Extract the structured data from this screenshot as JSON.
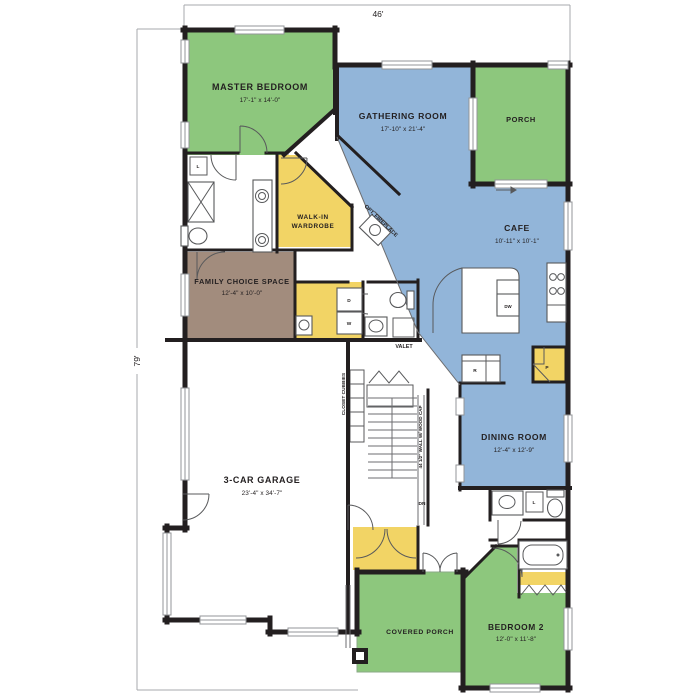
{
  "dims": {
    "width_label": "46'",
    "height_label": "79'"
  },
  "rooms": {
    "master_bedroom": {
      "name": "MASTER BEDROOM",
      "size": "17'-1\" x 14'-0\""
    },
    "gathering_room": {
      "name": "GATHERING ROOM",
      "size": "17'-10\" x 21'-4\""
    },
    "porch": {
      "name": "PORCH"
    },
    "cafe": {
      "name": "CAFE",
      "size": "10'-11\" x 10'-1\""
    },
    "walk_in_wardrobe": {
      "line1": "WALK-IN",
      "line2": "WARDROBE"
    },
    "family_choice": {
      "name": "FAMILY CHOICE SPACE",
      "size": "12'-4\" x 10'-0\""
    },
    "dining_room": {
      "name": "DINING ROOM",
      "size": "12'-4\" x 12'-9\""
    },
    "garage": {
      "name": "3-CAR GARAGE",
      "size": "23'-4\" x 34'-7\""
    },
    "covered_porch": {
      "name": "COVERED PORCH"
    },
    "bedroom_2": {
      "name": "BEDROOM 2",
      "size": "12'-0\" x 11'-8\""
    }
  },
  "annotations": {
    "opt_fireplace": "OPT. FIREPLACE",
    "valet": "VALET",
    "closet_cubbies": "CLOSET CUBBIES",
    "wall_cap": "44 1/2\" WALL W/ WOOD CAP",
    "down": "DN",
    "dryer": "D",
    "washer": "W",
    "refrigerator": "R",
    "pantry": "P",
    "dishwasher": "DW",
    "linen": "L"
  },
  "colors": {
    "bedroom_green": "#8dc77d",
    "living_blue": "#92b5d9",
    "closet_yellow": "#f2d465",
    "flex_brown": "#a28c7d",
    "wall_black": "#231f20",
    "window_gray": "#939598"
  }
}
